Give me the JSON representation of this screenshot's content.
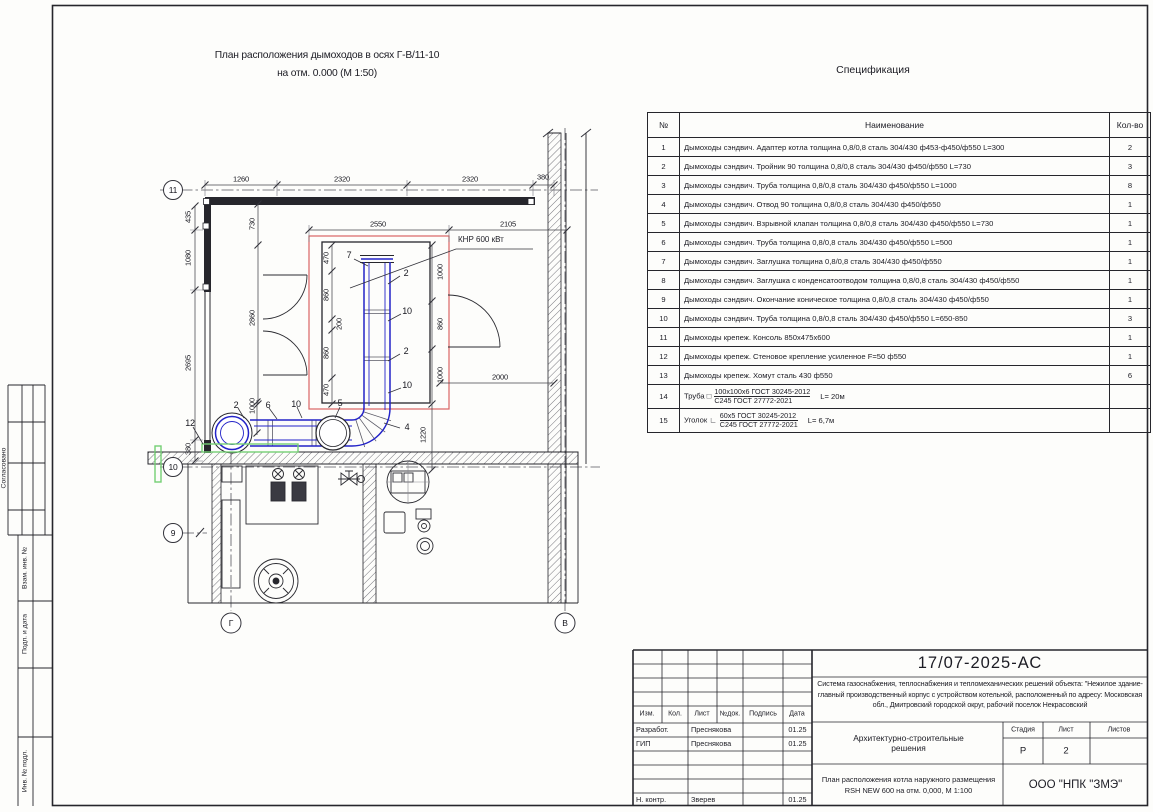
{
  "sheet": {
    "plan_title_line1": "План расположения дымоходов в осях Г-В/11-10",
    "plan_title_line2": "на отм. 0.000 (М 1:50)",
    "spec_title": "Спецификация"
  },
  "plan": {
    "boiler_label": "КНР 600 кВт",
    "axis_bubbles": [
      {
        "t": "11",
        "x": 173,
        "y": 190
      },
      {
        "t": "10",
        "x": 173,
        "y": 467
      },
      {
        "t": "9",
        "x": 173,
        "y": 533
      },
      {
        "t": "Г",
        "x": 231,
        "y": 623
      },
      {
        "t": "В",
        "x": 565,
        "y": 623
      }
    ],
    "dim_labels": [
      {
        "t": "1260",
        "x": 241,
        "y": 179
      },
      {
        "t": "2320",
        "x": 342,
        "y": 179
      },
      {
        "t": "2320",
        "x": 470,
        "y": 179
      },
      {
        "t": "380",
        "x": 543,
        "y": 177
      },
      {
        "t": "2550",
        "x": 378,
        "y": 224
      },
      {
        "t": "2105",
        "x": 508,
        "y": 224
      },
      {
        "t": "730",
        "x": 252,
        "y": 224,
        "rot": 1
      },
      {
        "t": "2860",
        "x": 252,
        "y": 318,
        "rot": 1
      },
      {
        "t": "435",
        "x": 188,
        "y": 217,
        "rot": 1
      },
      {
        "t": "1080",
        "x": 188,
        "y": 258,
        "rot": 1
      },
      {
        "t": "2695",
        "x": 188,
        "y": 363,
        "rot": 1
      },
      {
        "t": "380",
        "x": 188,
        "y": 449,
        "rot": 1
      },
      {
        "t": "470",
        "x": 326,
        "y": 258,
        "rot": 1
      },
      {
        "t": "860",
        "x": 326,
        "y": 295,
        "rot": 1
      },
      {
        "t": "200",
        "x": 339,
        "y": 324,
        "rot": 1
      },
      {
        "t": "860",
        "x": 326,
        "y": 353,
        "rot": 1
      },
      {
        "t": "470",
        "x": 326,
        "y": 390,
        "rot": 1
      },
      {
        "t": "1000",
        "x": 440,
        "y": 272,
        "rot": 1
      },
      {
        "t": "860",
        "x": 440,
        "y": 324,
        "rot": 1
      },
      {
        "t": "1000",
        "x": 440,
        "y": 375,
        "rot": 1
      },
      {
        "t": "1220",
        "x": 423,
        "y": 435,
        "rot": 1
      },
      {
        "t": "2000",
        "x": 500,
        "y": 377
      },
      {
        "t": "1000",
        "x": 252,
        "y": 406,
        "rot": 1
      }
    ],
    "item_labels": [
      {
        "t": "7",
        "x": 349,
        "y": 255
      },
      {
        "t": "2",
        "x": 406,
        "y": 273
      },
      {
        "t": "10",
        "x": 407,
        "y": 311
      },
      {
        "t": "2",
        "x": 406,
        "y": 351
      },
      {
        "t": "10",
        "x": 407,
        "y": 385
      },
      {
        "t": "4",
        "x": 407,
        "y": 427
      },
      {
        "t": "5",
        "x": 340,
        "y": 403
      },
      {
        "t": "10",
        "x": 296,
        "y": 404
      },
      {
        "t": "6",
        "x": 268,
        "y": 405
      },
      {
        "t": "2",
        "x": 236,
        "y": 405
      },
      {
        "t": "12",
        "x": 190,
        "y": 423
      }
    ]
  },
  "spec_table": {
    "headers": {
      "num": "№",
      "name": "Наименование",
      "qty": "Кол-во"
    },
    "rows": [
      {
        "num": "1",
        "name": "Дымоходы сэндвич. Адаптер котла толщина 0,8/0,8 сталь 304/430 ф453-ф450/ф550 L=300",
        "qty": "2"
      },
      {
        "num": "2",
        "name": "Дымоходы сэндвич. Тройник 90 толщина 0,8/0,8 сталь 304/430 ф450/ф550 L=730",
        "qty": "3"
      },
      {
        "num": "3",
        "name": "Дымоходы сэндвич. Труба толщина 0,8/0,8 сталь 304/430 ф450/ф550 L=1000",
        "qty": "8"
      },
      {
        "num": "4",
        "name": "Дымоходы сэндвич. Отвод 90 толщина 0,8/0,8 сталь 304/430 ф450/ф550",
        "qty": "1"
      },
      {
        "num": "5",
        "name": "Дымоходы сэндвич. Взрывной клапан толщина 0,8/0,8 сталь 304/430 ф450/ф550 L=730",
        "qty": "1"
      },
      {
        "num": "6",
        "name": "Дымоходы сэндвич. Труба толщина 0,8/0,8 сталь 304/430 ф450/ф550 L=500",
        "qty": "1"
      },
      {
        "num": "7",
        "name": "Дымоходы сэндвич. Заглушка толщина 0,8/0,8 сталь 304/430 ф450/ф550",
        "qty": "1"
      },
      {
        "num": "8",
        "name": "Дымоходы сэндвич. Заглушка с конденсатоотводом толщина 0,8/0,8 сталь 304/430 ф450/ф550",
        "qty": "1"
      },
      {
        "num": "9",
        "name": "Дымоходы сэндвич. Окончание коническое толщина 0,8/0,8 сталь 304/430 ф450/ф550",
        "qty": "1"
      },
      {
        "num": "10",
        "name": "Дымоходы сэндвич. Труба толщина 0,8/0,8 сталь 304/430 ф450/ф550 L=650-850",
        "qty": "3"
      },
      {
        "num": "11",
        "name": "Дымоходы крепеж. Консоль 850х475х600",
        "qty": "1"
      },
      {
        "num": "12",
        "name": "Дымоходы крепеж. Стеновое крепление усиленное F=50 ф550",
        "qty": "1"
      },
      {
        "num": "13",
        "name": "Дымоходы крепеж. Хомут сталь 430 ф550",
        "qty": "6"
      }
    ],
    "frac14": {
      "num": "14",
      "prefix": "Труба □",
      "top": "100х100х6 ГОСТ 30245-2012",
      "bottom": "С245 ГОСТ 27772-2021",
      "len": "L= 20м",
      "qty": ""
    },
    "frac15": {
      "num": "15",
      "prefix": "Уголок ∟",
      "top": "60х5 ГОСТ 30245-2012",
      "bottom": "С245 ГОСТ 27772-2021",
      "len": "L= 6,7м",
      "qty": ""
    }
  },
  "left_margin": {
    "fields": [
      "Согласовано",
      "Взам. инв. №",
      "Подп. и дата",
      "Инв. № подл."
    ]
  },
  "title_block": {
    "doc_code": "17/07-2025-АС",
    "description": "Система газоснабжения, теплоснабжения и тепломеханических решений объекта: \"Нежилое здание-главный производственный корпус с устройством котельной, расположенный по адресу: Московская обл., Дмитровский городской округ, рабочий поселок Некрасовский",
    "section": "Архитектурно-строительные решения",
    "sheet_name_line1": "План расположения котла наружного размещения",
    "sheet_name_line2": "RSH NEW 600 на отм. 0,000,  М 1:100",
    "company": "ООО \"НПК \"ЗМЭ\"",
    "cols": {
      "izm": "Изм.",
      "kol": "Кол.",
      "list": "Лист",
      "ndok": "№док.",
      "podpis": "Подпись",
      "data": "Дата"
    },
    "stage_headers": {
      "stage": "Стадия",
      "sheet": "Лист",
      "sheets": "Листов"
    },
    "stage_values": {
      "stage": "Р",
      "sheet": "2",
      "sheets": ""
    },
    "people": [
      {
        "role": "Разработ.",
        "name": "Преснякова",
        "sign": "",
        "date": "01.25"
      },
      {
        "role": "ГИП",
        "name": "Преснякова",
        "sign": "",
        "date": "01.25"
      },
      {
        "role": "",
        "name": "",
        "sign": "",
        "date": ""
      },
      {
        "role": "",
        "name": "",
        "sign": "",
        "date": ""
      },
      {
        "role": "",
        "name": "",
        "sign": "",
        "date": ""
      },
      {
        "role": "Н. контр.",
        "name": "Зверев",
        "sign": "",
        "date": "01.25"
      }
    ]
  },
  "colors": {
    "pipe": "#2323c8",
    "highlight": "#d96464",
    "bracket": "#74cf74",
    "line": "#26262c"
  }
}
